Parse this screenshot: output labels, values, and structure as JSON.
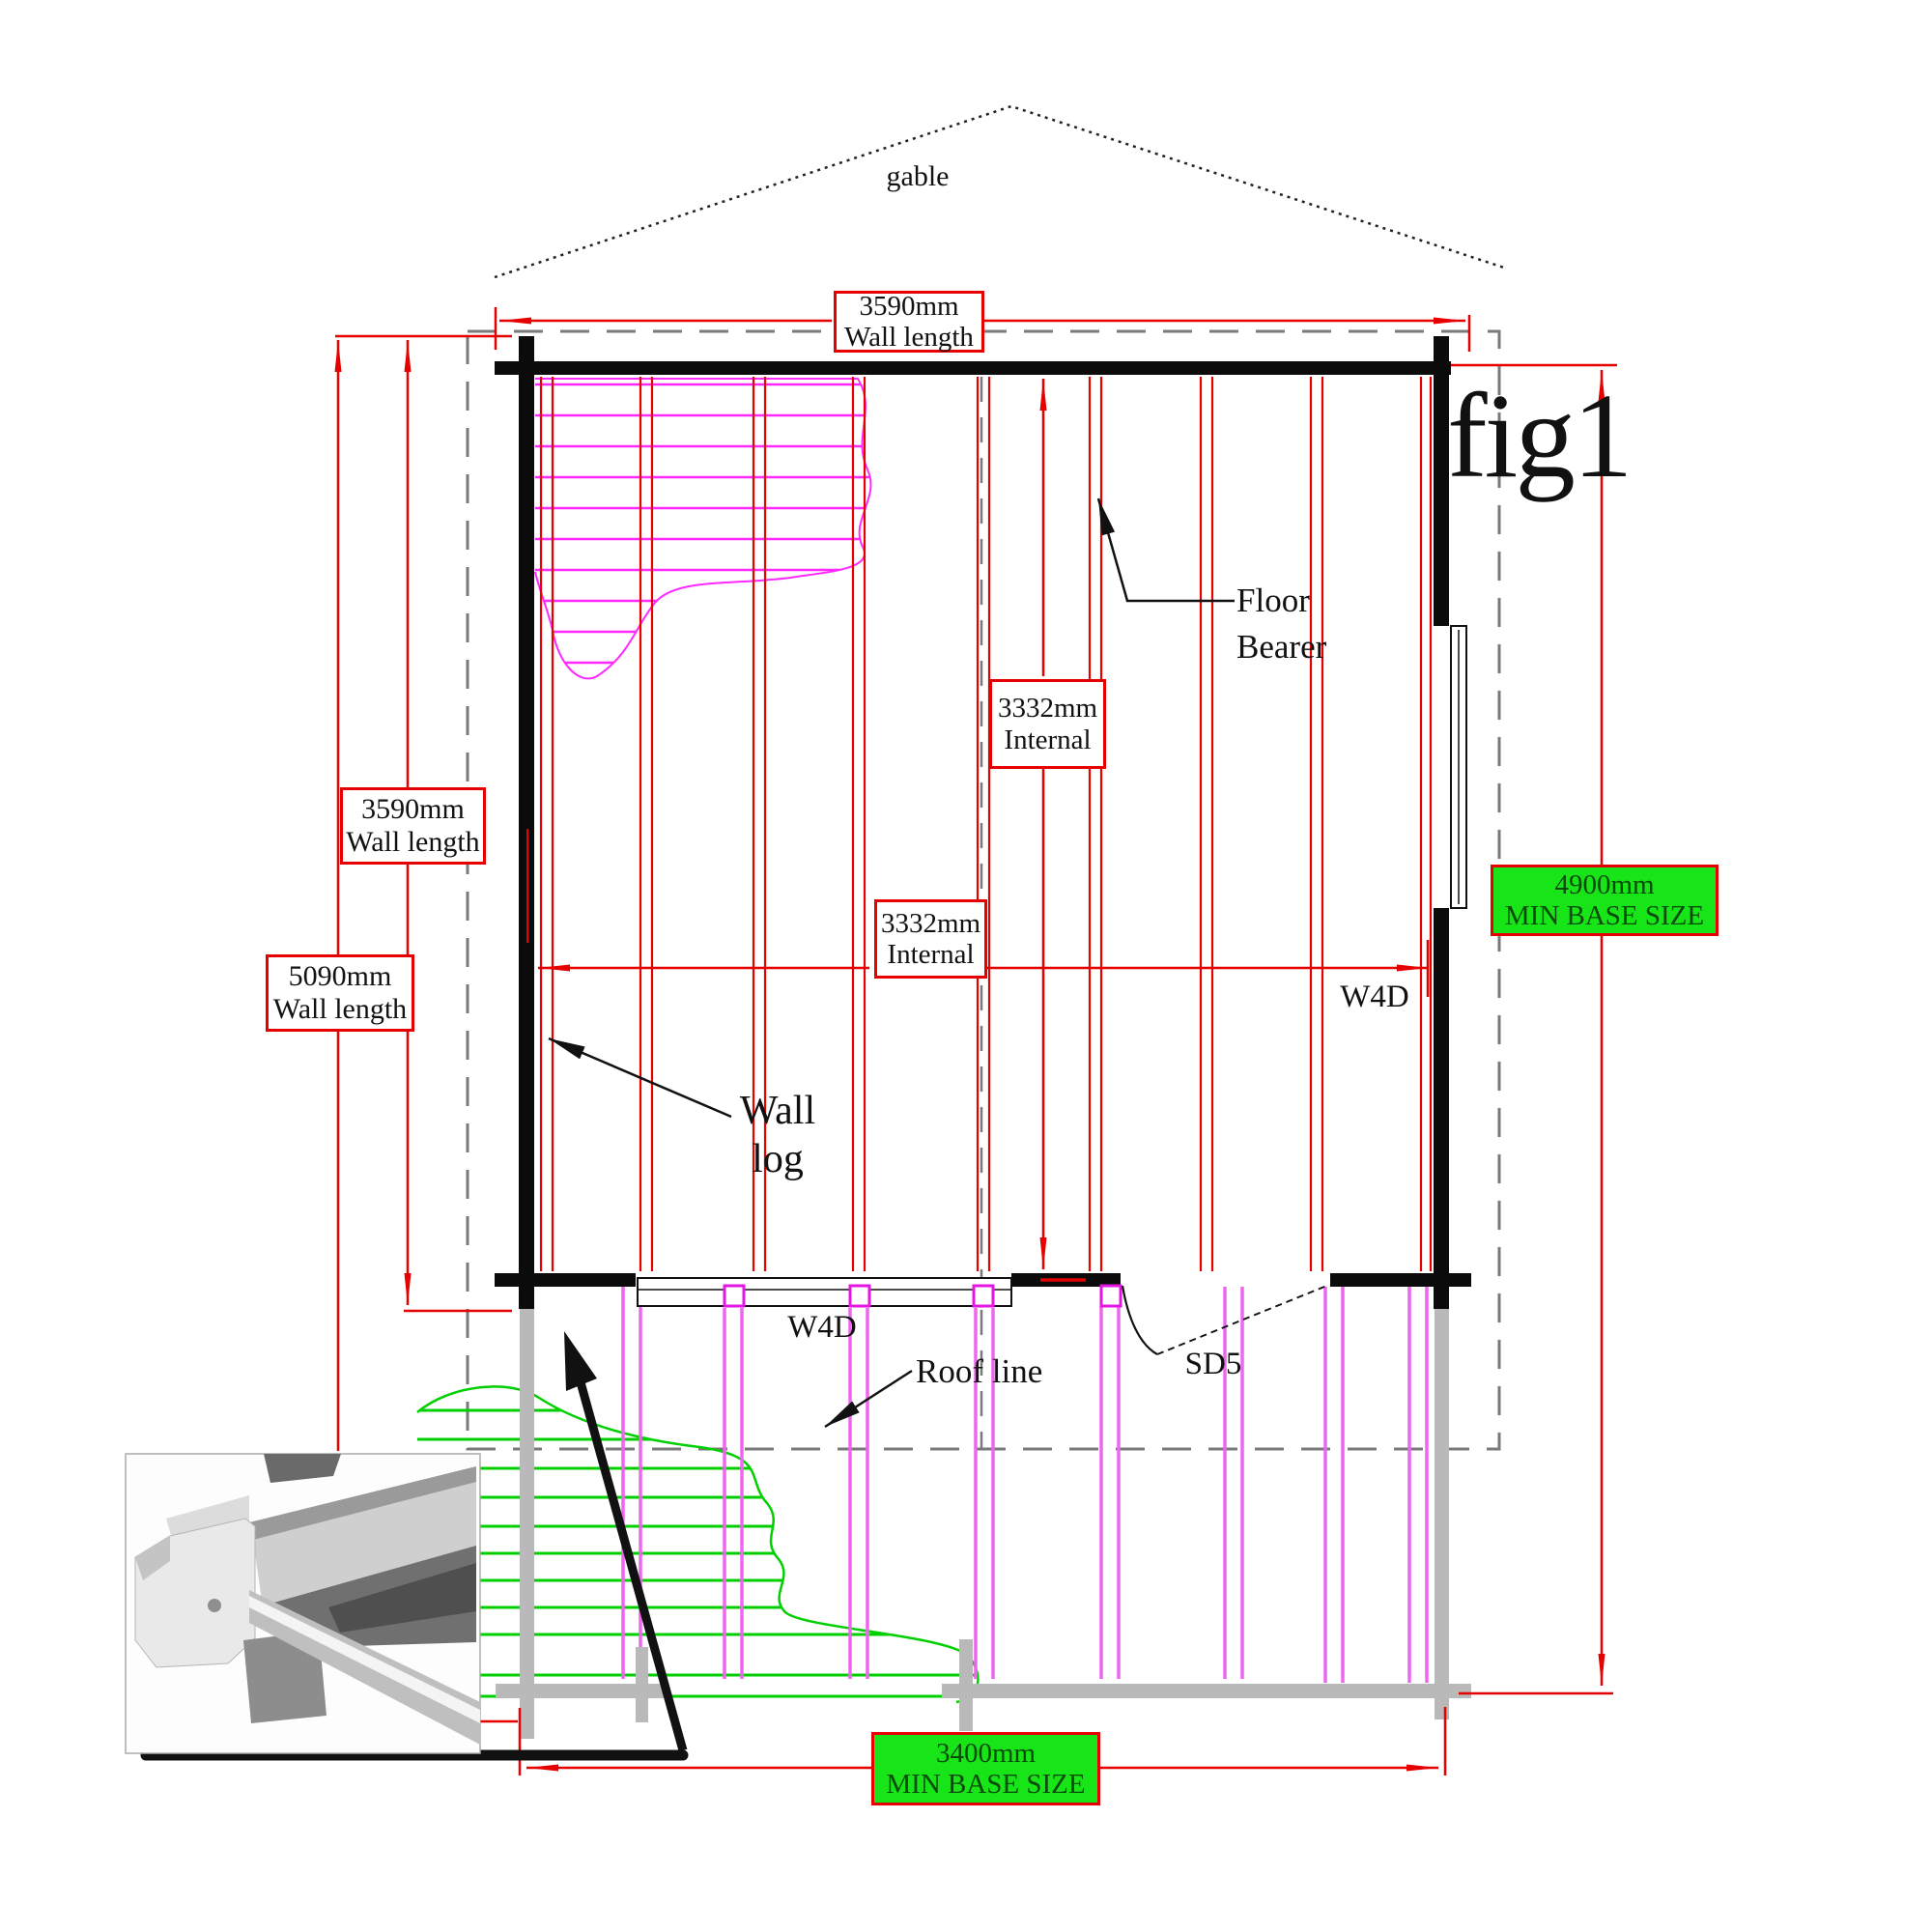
{
  "figure": {
    "label": "fig1"
  },
  "labels": {
    "gable": "gable",
    "floor_bearer_line1": "Floor",
    "floor_bearer_line2": "Bearer",
    "wall_log_line1": "Wall",
    "wall_log_line2": "log",
    "roof_line": "Roof line",
    "window_right": "W4D",
    "window_bottom": "W4D",
    "door": "SD5"
  },
  "dimensions": {
    "top_wall": {
      "value": "3590mm",
      "label": "Wall length"
    },
    "left_wall_inner": {
      "value": "3590mm",
      "label": "Wall length"
    },
    "left_wall_outer": {
      "value": "5090mm",
      "label": "Wall length"
    },
    "internal_upper": {
      "value": "3332mm",
      "label": "Internal"
    },
    "internal_middle": {
      "value": "3332mm",
      "label": "Internal"
    },
    "base_right": {
      "value": "4900mm",
      "label": "MIN BASE SIZE"
    },
    "base_bottom": {
      "value": "3400mm",
      "label": "MIN BASE SIZE"
    }
  },
  "colors": {
    "dimension_red": "#e60000",
    "wall_black": "#0b0b0b",
    "roof_dash_gray": "#7a7a7a",
    "hatch_pink": "#ff29ff",
    "hatch_green": "#00cf00",
    "base_badge_green": "#17e517",
    "bearer_gray": "#b9b9b9"
  }
}
